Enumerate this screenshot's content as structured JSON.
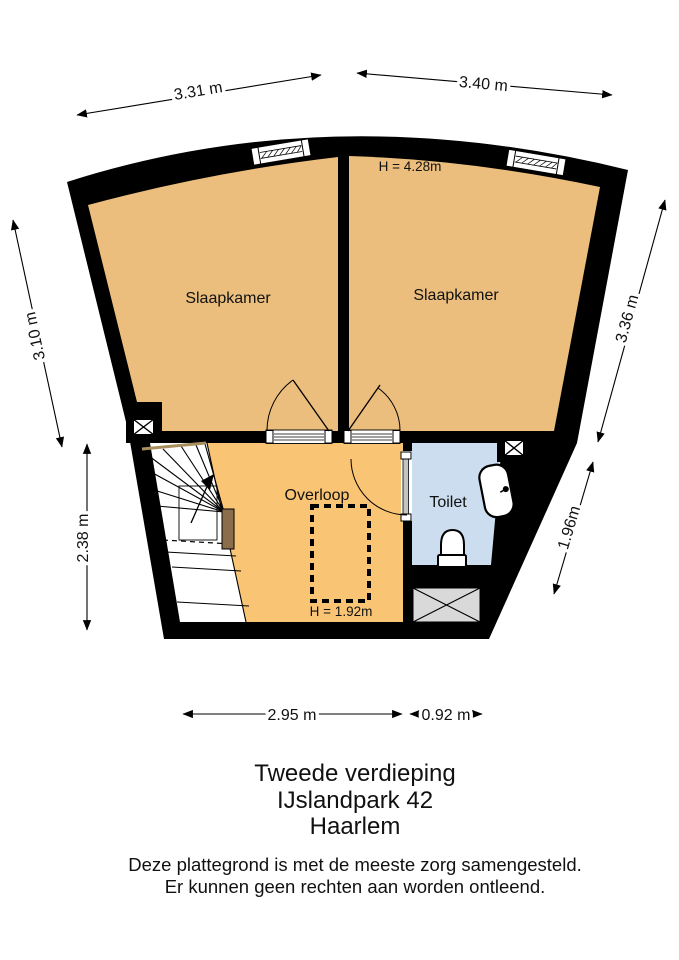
{
  "title_block": {
    "floor_label": "Tweede verdieping",
    "address": "IJslandpark 42",
    "city": "Haarlem"
  },
  "disclaimer": {
    "line1": "Deze plattegrond is met de meeste zorg samengesteld.",
    "line2": "Er kunnen geen rechten aan worden ontleend."
  },
  "rooms": {
    "bedroom_left": {
      "label": "Slaapkamer"
    },
    "bedroom_right": {
      "label": "Slaapkamer",
      "ceiling_height": "H = 4.28m"
    },
    "landing": {
      "label": "Overloop",
      "ceiling_height": "H = 1.92m"
    },
    "toilet": {
      "label": "Toilet"
    }
  },
  "dimensions": {
    "top_left": "3.31 m",
    "top_right": "3.40 m",
    "left_upper": "3.10 m",
    "left_lower": "2.38 m",
    "right_upper": "3.36 m",
    "right_lower": "1.96m",
    "bottom_main": "2.95 m",
    "bottom_small": "0.92 m"
  },
  "colors": {
    "wall": "#000000",
    "bedroom_floor": "#EBBE7D",
    "landing_floor": "#F9C473",
    "toilet_floor": "#CBDDEE",
    "stair_floor": "#FFFFFF",
    "shaft_fill": "#D9D9D9",
    "wood": "#8A6D4B",
    "wood_trim": "#A98F5E",
    "door_leaf": "#C4C4C4"
  },
  "icons": {
    "shaft_symbol": "crossed-box-icon",
    "void_symbol": "gray-crossed-box-icon",
    "stair_direction": "up-arrow-icon"
  }
}
